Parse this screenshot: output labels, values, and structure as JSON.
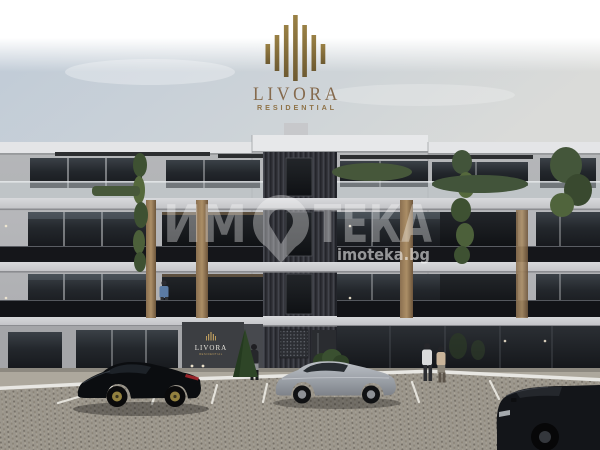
{
  "logo": {
    "brand": "LIVORA",
    "tagline": "RESIDENTIAL",
    "bar_color": "#8a7344",
    "text_color": "#856a4d"
  },
  "watermark": {
    "full": "ИМОТЕКА",
    "part_before_pin": "ИМ",
    "part_after_pin": "ТЕКА",
    "site": "imoteka.bg",
    "color": "#ffffff"
  },
  "building": {
    "floors": 4,
    "entrance_sign": {
      "brand": "LIVORA",
      "tagline": "RESIDENTIAL"
    },
    "colors": {
      "wall": "#b4b5b8",
      "parapet": "#e4e5e7",
      "glass": "#23272c",
      "railing": "#16171a",
      "wood_accent": "#97795a",
      "center_strip": "#35363c"
    }
  },
  "scene": {
    "sky_color": "#c6cfd8",
    "pavement_color": "#9b968c",
    "cars": [
      {
        "name": "black-sports-coupe",
        "color": "#0b0d10",
        "wheel_accent": "#93813f"
      },
      {
        "name": "silver-sedan",
        "color": "#9599a0",
        "wheel_accent": "#8e9196"
      },
      {
        "name": "black-suv",
        "color": "#131519",
        "wheel_accent": "#34373c"
      }
    ],
    "people_count": 4
  }
}
